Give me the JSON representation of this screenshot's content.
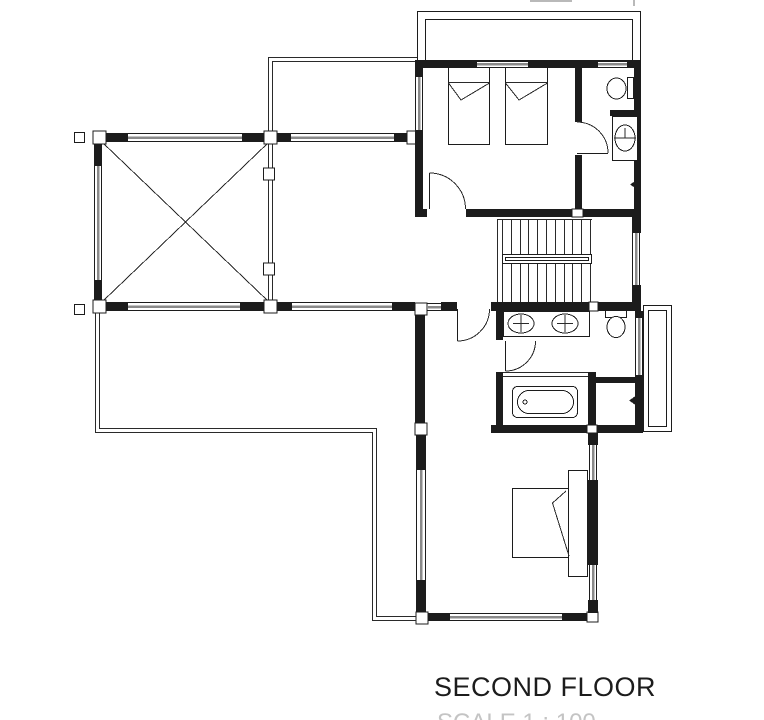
{
  "title": "SECOND FLOOR",
  "footer_partial": "SCALE 1 : 100",
  "colors": {
    "ink": "#1c1c1c",
    "sill_gray": "#8a8a8a",
    "faint_gray": "#c4c4c4",
    "background": "#ffffff"
  }
}
